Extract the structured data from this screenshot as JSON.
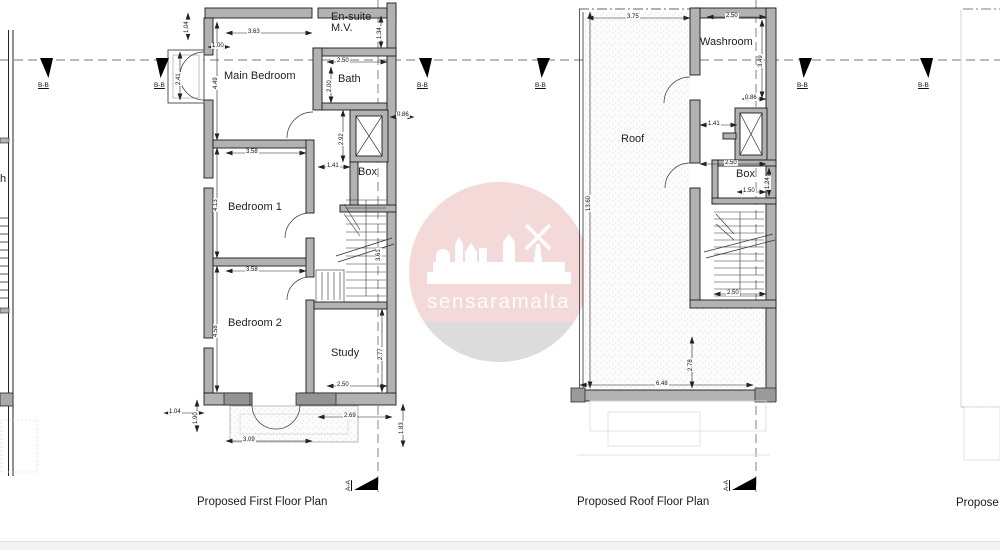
{
  "watermark": {
    "text": "sensaramalta",
    "circle_color": "#f3dad8",
    "segment_color": "#dcdcdc",
    "text_color": "#ffffff"
  },
  "titles": {
    "first_floor": "Proposed First Floor Plan",
    "roof": "Proposed Roof Floor Plan",
    "partial_right": "Propose"
  },
  "section_markers": {
    "bb": {
      "label": "B-B",
      "items": [
        {
          "x": 40,
          "flip": 1
        },
        {
          "x": 156,
          "flip": 0
        },
        {
          "x": 419,
          "flip": 1
        },
        {
          "x": 537,
          "flip": 0
        },
        {
          "x": 799,
          "flip": 0
        },
        {
          "x": 920,
          "flip": 1
        }
      ]
    },
    "aa": {
      "label": "A-A",
      "items": [
        {
          "x": 354
        },
        {
          "x": 732
        }
      ]
    }
  },
  "first_floor": {
    "rooms": [
      {
        "t": "Main Bedroom",
        "x": 224,
        "y": 71
      },
      {
        "t": "En-suite",
        "x": 331,
        "y": 12
      },
      {
        "t": "M.V.",
        "x": 331,
        "y": 23
      },
      {
        "t": "Bath",
        "x": 338,
        "y": 74
      },
      {
        "t": "Box",
        "x": 358,
        "y": 167
      },
      {
        "t": "Bedroom 1",
        "x": 228,
        "y": 202
      },
      {
        "t": "Bedroom 2",
        "x": 228,
        "y": 318
      },
      {
        "t": "Study",
        "x": 331,
        "y": 348
      }
    ],
    "dims": [
      {
        "t": "1.04",
        "x": 184,
        "y": 34,
        "r": 1
      },
      {
        "t": "3.63",
        "x": 247,
        "y": 29
      },
      {
        "t": "1.00",
        "x": 211,
        "y": 43
      },
      {
        "t": "2.41",
        "x": 176,
        "y": 86,
        "r": 1
      },
      {
        "t": "4.49",
        "x": 213,
        "y": 90,
        "r": 1
      },
      {
        "t": "2.50",
        "x": 336,
        "y": 58
      },
      {
        "t": "2.00",
        "x": 327,
        "y": 93,
        "r": 1
      },
      {
        "t": "1.34",
        "x": 377,
        "y": 40,
        "r": 1
      },
      {
        "t": "0.86",
        "x": 396,
        "y": 112
      },
      {
        "t": "2.92",
        "x": 339,
        "y": 146,
        "r": 1
      },
      {
        "t": "1.41",
        "x": 326,
        "y": 163
      },
      {
        "t": "3.58",
        "x": 245,
        "y": 149
      },
      {
        "t": "4.13",
        "x": 213,
        "y": 212,
        "r": 1
      },
      {
        "t": "3.58",
        "x": 245,
        "y": 267
      },
      {
        "t": "4.58",
        "x": 213,
        "y": 338,
        "r": 1
      },
      {
        "t": "3.61",
        "x": 376,
        "y": 262,
        "r": 1
      },
      {
        "t": "2.77",
        "x": 378,
        "y": 361,
        "r": 1
      },
      {
        "t": "2.50",
        "x": 336,
        "y": 382
      },
      {
        "t": "1.04",
        "x": 168,
        "y": 409
      },
      {
        "t": "1.90",
        "x": 193,
        "y": 425,
        "r": 1
      },
      {
        "t": "3.09",
        "x": 242,
        "y": 437
      },
      {
        "t": "2.69",
        "x": 343,
        "y": 413
      },
      {
        "t": "1.83",
        "x": 399,
        "y": 435,
        "r": 1
      }
    ]
  },
  "roof": {
    "rooms": [
      {
        "t": "Washroom",
        "x": 700,
        "y": 37
      },
      {
        "t": "Roof",
        "x": 621,
        "y": 134
      },
      {
        "t": "Box",
        "x": 736,
        "y": 169
      }
    ],
    "dims": [
      {
        "t": "3.75",
        "x": 626,
        "y": 14
      },
      {
        "t": "2.50",
        "x": 725,
        "y": 13
      },
      {
        "t": "3.49",
        "x": 758,
        "y": 68,
        "r": 1
      },
      {
        "t": "0.86",
        "x": 744,
        "y": 95
      },
      {
        "t": "1.41",
        "x": 707,
        "y": 121
      },
      {
        "t": "2.50",
        "x": 724,
        "y": 160
      },
      {
        "t": "1.24",
        "x": 765,
        "y": 190,
        "r": 1
      },
      {
        "t": "1.50",
        "x": 742,
        "y": 188
      },
      {
        "t": "13.60",
        "x": 586,
        "y": 212,
        "r": 1
      },
      {
        "t": "2.50",
        "x": 726,
        "y": 290
      },
      {
        "t": "6.48",
        "x": 655,
        "y": 381
      },
      {
        "t": "2.78",
        "x": 688,
        "y": 372,
        "r": 1
      }
    ]
  },
  "left_partial": {
    "rooms": [
      {
        "t": "h",
        "x": 0,
        "y": 174
      }
    ],
    "dims": []
  }
}
